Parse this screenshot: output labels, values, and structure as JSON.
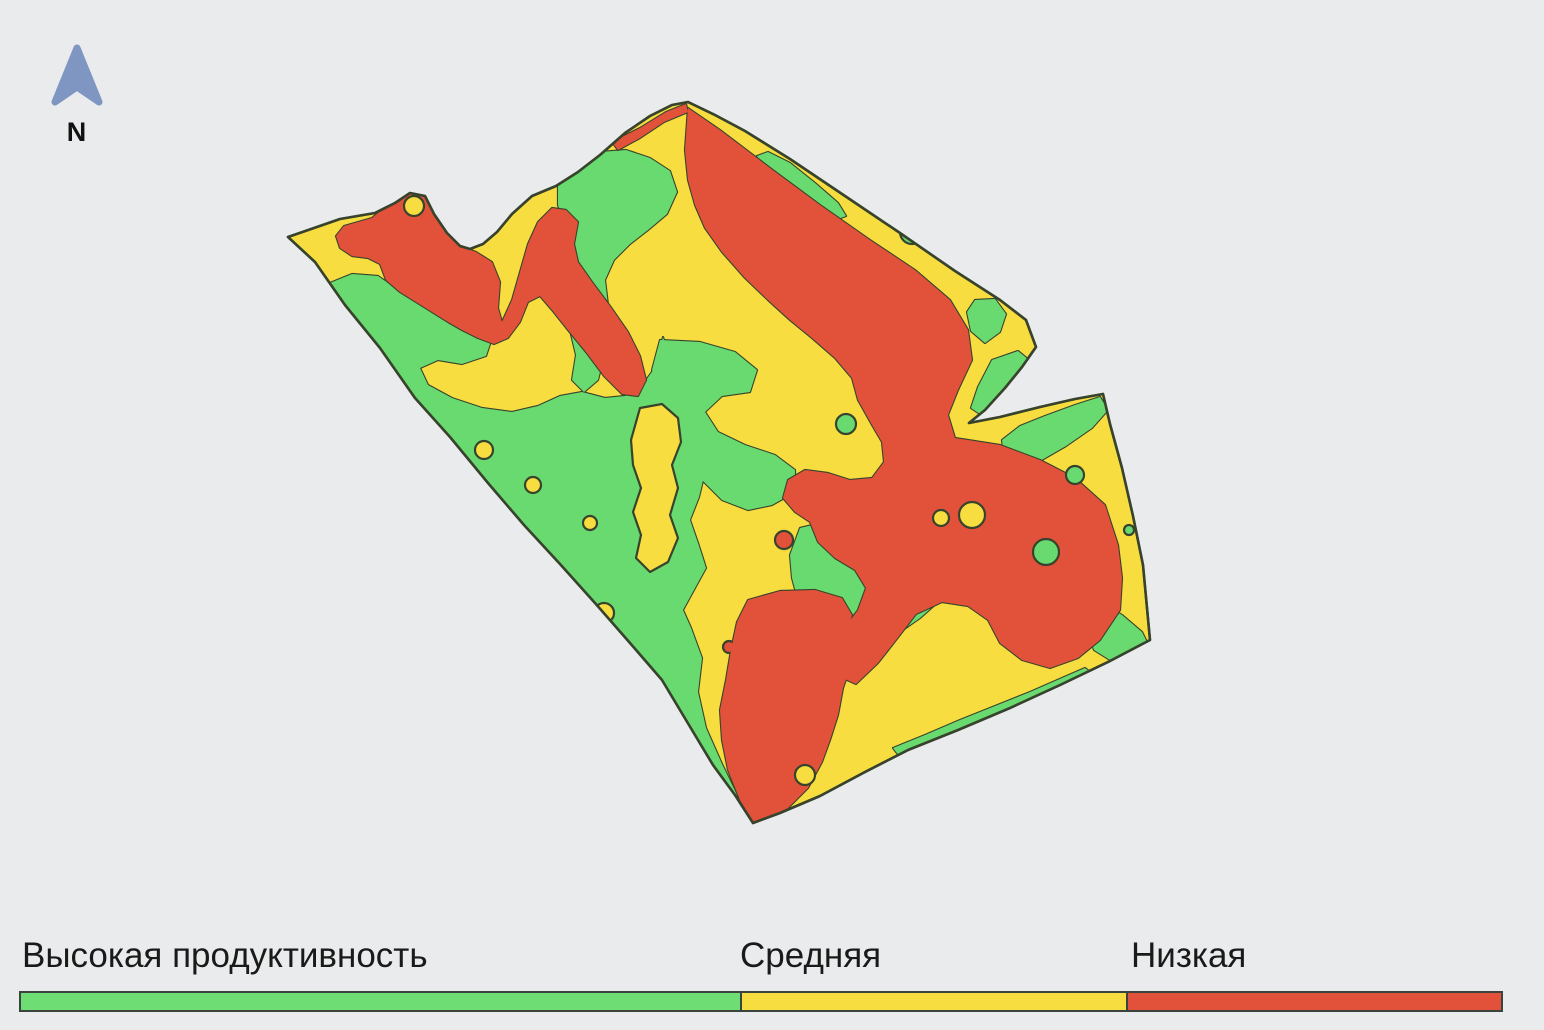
{
  "map": {
    "type": "field productivity zone map",
    "background_color": "#eaebec",
    "outline_color": "#37432c",
    "zone_colors": {
      "high": "#69da6f",
      "medium": "#f8dd40",
      "low": "#e2523a"
    },
    "north_arrow": {
      "label": "N",
      "color": "#7e96c1"
    }
  },
  "legend": {
    "items": [
      {
        "label": "Высокая продуктивность",
        "color": "#6edd74",
        "zone": "high",
        "bar_width_px": 723,
        "label_x_px": 22
      },
      {
        "label": "Средняя",
        "color": "#f8dd40",
        "zone": "medium",
        "bar_width_px": 386,
        "label_x_px": 740
      },
      {
        "label": "Низкая",
        "color": "#e2523a",
        "zone": "low",
        "bar_width_px": 375,
        "label_x_px": 1131
      }
    ],
    "bar": {
      "x_px": 19,
      "y_px": 991,
      "height_px": 21,
      "total_width_px": 1484
    }
  }
}
